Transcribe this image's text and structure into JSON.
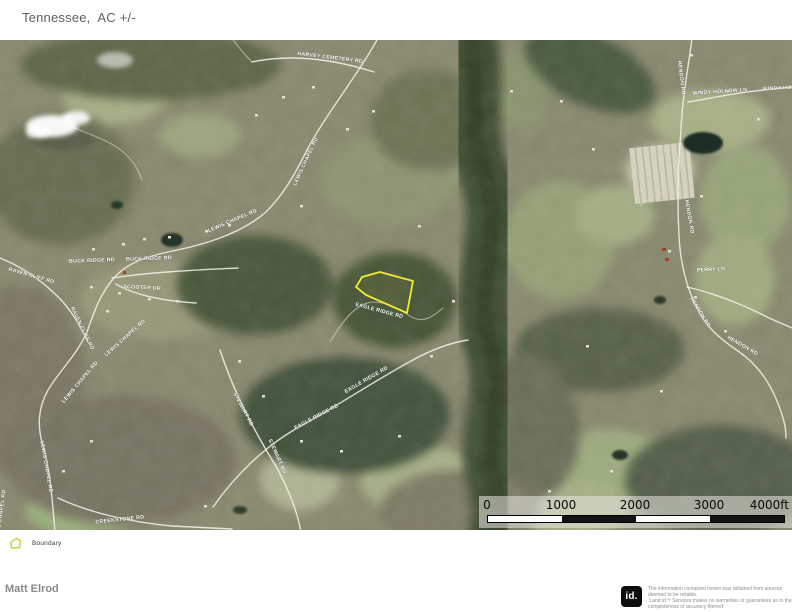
{
  "title": "Tennessee,  AC +/-",
  "map": {
    "road_labels": [
      {
        "text": "HARVEY CEMETERY RD"
      },
      {
        "text": "LEWIS CHAPEL RD"
      },
      {
        "text": "LEWIS CHAPEL RD"
      },
      {
        "text": "BUCK RIDGE RD"
      },
      {
        "text": "BUCK RIDGE RD"
      },
      {
        "text": "SCOOTER DR"
      },
      {
        "text": "RAVEN CLIFF RD"
      },
      {
        "text": "RAVEN CLIFF RD"
      },
      {
        "text": "LEWIS CHAPEL RD"
      },
      {
        "text": "LEWIS CHAPEL RD"
      },
      {
        "text": "LEWIS CHAPEL RD"
      },
      {
        "text": "LEWIS CHAPEL RD"
      },
      {
        "text": "CREEKSTONE RD"
      },
      {
        "text": "STEWART RD"
      },
      {
        "text": "STEWART RD"
      },
      {
        "text": "EAGLE RIDGE RD"
      },
      {
        "text": "EAGLE RIDGE RD"
      },
      {
        "text": "EAGLE RIDGE RD"
      },
      {
        "text": "HENDON RD"
      },
      {
        "text": "HENDON RD"
      },
      {
        "text": "PERRY LN"
      },
      {
        "text": "HENDON RD"
      },
      {
        "text": "HENDON RD"
      },
      {
        "text": "WINDY HOLLOW LN"
      },
      {
        "text": "WINDY HOLLOW LN"
      }
    ],
    "scale_ticks": [
      "0",
      "1000",
      "2000",
      "3000",
      "4000ft"
    ],
    "boundary_color": "#f2e836"
  },
  "legend": {
    "items": [
      {
        "label": "Boundary",
        "color": "#cdd13c"
      }
    ]
  },
  "footer": {
    "author": "Matt Elrod",
    "logo_text": "id.",
    "disclaimer_lines": [
      "The information contained herein was obtained from sources",
      "deemed to be reliable.",
      " Land id™ Services makes no warranties or guarantees as to the",
      "completeness or accuracy thereof."
    ]
  }
}
